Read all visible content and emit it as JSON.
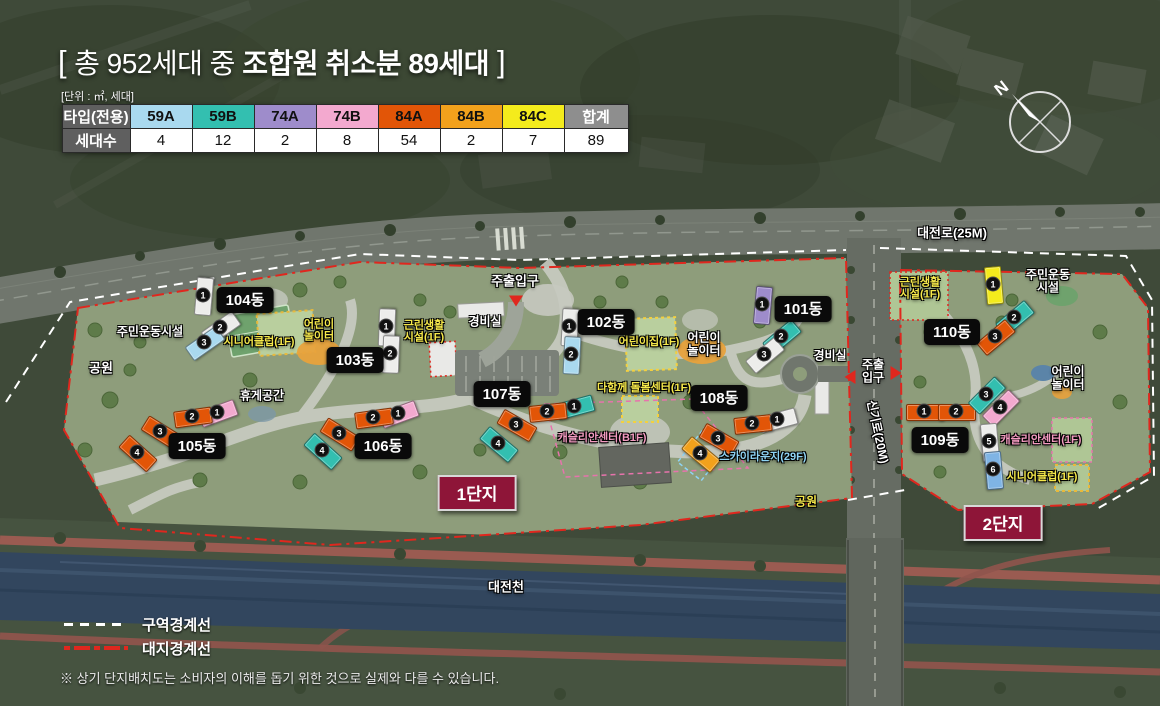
{
  "title": {
    "open_bracket": "[",
    "normal": "총 952세대 중 ",
    "bold": "조합원 취소분 89세대",
    "close_bracket": "]"
  },
  "unit_note": "[단위 : ㎡, 세대]",
  "table": {
    "header_label": "타입(전용)",
    "row_label": "세대수",
    "total_label": "합계",
    "total_count": "89",
    "types": [
      {
        "label": "59A",
        "count": "4",
        "color": "#A9D9EF"
      },
      {
        "label": "59B",
        "count": "12",
        "color": "#33BFB0"
      },
      {
        "label": "74A",
        "count": "2",
        "color": "#9E8CCB"
      },
      {
        "label": "74B",
        "count": "8",
        "color": "#F3A9CF"
      },
      {
        "label": "84A",
        "count": "54",
        "color": "#E25507"
      },
      {
        "label": "84B",
        "count": "2",
        "color": "#F2A11C"
      },
      {
        "label": "84C",
        "count": "7",
        "color": "#F4EB1C"
      }
    ]
  },
  "compass": {
    "north_label": "N"
  },
  "legend": [
    {
      "label": "구역경계선",
      "style": "ls-white"
    },
    {
      "label": "대지경계선",
      "style": "ls-red"
    }
  ],
  "footnote": "※ 상기 단지배치도는 소비자의 이해를 돕기 위한 것으로 실제와 다를 수 있습니다.",
  "colors": {
    "unit_types": {
      "white": "#EDEDEB",
      "lightblue": "#A9D9EF",
      "teal": "#33BFB0",
      "purple": "#9E8CCB",
      "pink": "#F3A9CF",
      "orangered": "#E25507",
      "orange": "#F2A11C",
      "yellow": "#F4EB1C",
      "blue": "#7FB4E4"
    },
    "boundary_zone": "#FFFFFF",
    "boundary_site": "#E0271E",
    "danji_bg": "#8E1538",
    "building_pill_bg": "#0A0A0A"
  },
  "map": {
    "districts": [
      {
        "text": "1단지",
        "x": 477,
        "y": 493
      },
      {
        "text": "2단지",
        "x": 1003,
        "y": 523
      }
    ],
    "buildings": [
      {
        "name": "101동",
        "px": 803,
        "py": 309,
        "units": [
          {
            "n": "1",
            "c": "purple",
            "x": 762,
            "y": 304,
            "r": -85
          },
          {
            "n": "2",
            "c": "teal",
            "x": 781,
            "y": 336,
            "r": -40
          },
          {
            "n": "3",
            "c": "white",
            "x": 764,
            "y": 354,
            "r": -40
          }
        ]
      },
      {
        "name": "102동",
        "px": 606,
        "py": 322,
        "units": [
          {
            "n": "1",
            "c": "white",
            "x": 569,
            "y": 326,
            "r": -87
          },
          {
            "n": "2",
            "c": "lightblue",
            "x": 571,
            "y": 354,
            "r": -87
          }
        ]
      },
      {
        "name": "103동",
        "px": 355,
        "py": 360,
        "units": [
          {
            "n": "1",
            "c": "white",
            "x": 386,
            "y": 326,
            "r": -88
          },
          {
            "n": "2",
            "c": "white",
            "x": 390,
            "y": 353,
            "r": -88
          }
        ]
      },
      {
        "name": "104동",
        "px": 245,
        "py": 300,
        "units": [
          {
            "n": "1",
            "c": "white",
            "x": 203,
            "y": 295,
            "r": -85
          },
          {
            "n": "2",
            "c": "white",
            "x": 220,
            "y": 327,
            "r": -35
          },
          {
            "n": "3",
            "c": "lightblue",
            "x": 204,
            "y": 342,
            "r": -35
          }
        ]
      },
      {
        "name": "105동",
        "px": 197,
        "py": 446,
        "units": [
          {
            "n": "1",
            "c": "pink",
            "x": 217,
            "y": 412,
            "r": -20
          },
          {
            "n": "2",
            "c": "orangered",
            "x": 192,
            "y": 416,
            "r": -8
          },
          {
            "n": "3",
            "c": "orangered",
            "x": 160,
            "y": 431,
            "r": 32
          },
          {
            "n": "4",
            "c": "orangered",
            "x": 137,
            "y": 452,
            "r": 42
          }
        ]
      },
      {
        "name": "106동",
        "px": 383,
        "py": 446,
        "units": [
          {
            "n": "1",
            "c": "pink",
            "x": 398,
            "y": 413,
            "r": -20
          },
          {
            "n": "2",
            "c": "orangered",
            "x": 373,
            "y": 417,
            "r": -8
          },
          {
            "n": "3",
            "c": "orangered",
            "x": 339,
            "y": 433,
            "r": 32
          },
          {
            "n": "4",
            "c": "teal",
            "x": 322,
            "y": 450,
            "r": 42
          }
        ]
      },
      {
        "name": "107동",
        "px": 502,
        "py": 394,
        "units": [
          {
            "n": "1",
            "c": "teal",
            "x": 574,
            "y": 406,
            "r": -15
          },
          {
            "n": "2",
            "c": "orangered",
            "x": 547,
            "y": 411,
            "r": -6
          },
          {
            "n": "3",
            "c": "orangered",
            "x": 516,
            "y": 424,
            "r": 30
          },
          {
            "n": "4",
            "c": "teal",
            "x": 498,
            "y": 443,
            "r": 40
          }
        ]
      },
      {
        "name": "108동",
        "px": 719,
        "py": 398,
        "units": [
          {
            "n": "1",
            "c": "white",
            "x": 777,
            "y": 419,
            "r": -15
          },
          {
            "n": "2",
            "c": "orangered",
            "x": 752,
            "y": 423,
            "r": -6
          },
          {
            "n": "3",
            "c": "orangered",
            "x": 718,
            "y": 438,
            "r": 30
          },
          {
            "n": "4",
            "c": "orange",
            "x": 700,
            "y": 453,
            "r": 40
          }
        ]
      },
      {
        "name": "109동",
        "px": 940,
        "py": 440,
        "units": [
          {
            "n": "1",
            "c": "orangered",
            "x": 924,
            "y": 411,
            "r": 0
          },
          {
            "n": "2",
            "c": "orangered",
            "x": 956,
            "y": 411,
            "r": 0
          },
          {
            "n": "3",
            "c": "teal",
            "x": 986,
            "y": 394,
            "r": -45
          },
          {
            "n": "4",
            "c": "pink",
            "x": 1000,
            "y": 407,
            "r": -45
          },
          {
            "n": "5",
            "c": "white",
            "x": 989,
            "y": 441,
            "r": 85
          },
          {
            "n": "6",
            "c": "blue",
            "x": 993,
            "y": 469,
            "r": 85
          }
        ]
      },
      {
        "name": "110동",
        "px": 952,
        "py": 332,
        "units": [
          {
            "n": "1",
            "c": "yellow",
            "x": 993,
            "y": 284,
            "r": 85
          },
          {
            "n": "2",
            "c": "teal",
            "x": 1014,
            "y": 317,
            "r": -40
          },
          {
            "n": "3",
            "c": "orangered",
            "x": 995,
            "y": 336,
            "r": -40
          }
        ]
      }
    ],
    "labels": [
      {
        "text": "주민운동시설",
        "x": 150,
        "y": 332,
        "cls": "lc-white",
        "size": 12
      },
      {
        "text": "공원",
        "x": 101,
        "y": 369,
        "cls": "lc-white",
        "size": 13
      },
      {
        "text": "시니어클럽(1F)",
        "x": 259,
        "y": 342,
        "cls": "lc-yellow",
        "size": 11
      },
      {
        "text": "어린이\n놀이터",
        "x": 319,
        "y": 331,
        "cls": "lc-yellow",
        "size": 11
      },
      {
        "text": "근린생활\n시설(1F)",
        "x": 424,
        "y": 332,
        "cls": "lc-yellow",
        "size": 11
      },
      {
        "text": "경비실",
        "x": 485,
        "y": 322,
        "cls": "lc-white",
        "size": 12
      },
      {
        "text": "주출입구",
        "x": 515,
        "y": 282,
        "cls": "lc-white",
        "size": 13
      },
      {
        "text": "어린이집(1F)",
        "x": 649,
        "y": 342,
        "cls": "lc-yellow",
        "size": 11
      },
      {
        "text": "어린이\n놀이터",
        "x": 704,
        "y": 345,
        "cls": "lc-white",
        "size": 12
      },
      {
        "text": "다함께 돌봄센터(1F)",
        "x": 644,
        "y": 388,
        "cls": "lc-yellow",
        "size": 11
      },
      {
        "text": "캐슬리안센터(B1F)",
        "x": 602,
        "y": 438,
        "cls": "lc-pink",
        "size": 11
      },
      {
        "text": "스카이라운지(29F)",
        "x": 763,
        "y": 457,
        "cls": "lc-skyblue",
        "size": 11
      },
      {
        "text": "경비실",
        "x": 830,
        "y": 356,
        "cls": "lc-white",
        "size": 12
      },
      {
        "text": "대전로(25M)",
        "x": 952,
        "y": 234,
        "cls": "lc-white",
        "size": 13
      },
      {
        "text": "근린생활\n시설(1F)",
        "x": 920,
        "y": 289,
        "cls": "lc-yellow",
        "size": 11
      },
      {
        "text": "주민운동\n시설",
        "x": 1048,
        "y": 282,
        "cls": "lc-white",
        "size": 12
      },
      {
        "text": "주출\n입구",
        "x": 873,
        "y": 372,
        "cls": "lc-white",
        "size": 12
      },
      {
        "text": "신기로(20M)",
        "x": 877,
        "y": 432,
        "cls": "lc-white",
        "size": 12,
        "rot": 78
      },
      {
        "text": "어린이\n놀이터",
        "x": 1068,
        "y": 379,
        "cls": "lc-white",
        "size": 12
      },
      {
        "text": "캐슬리안센터(1F)",
        "x": 1041,
        "y": 440,
        "cls": "lc-pink",
        "size": 11
      },
      {
        "text": "시니어클럽(1F)",
        "x": 1042,
        "y": 477,
        "cls": "lc-yellow",
        "size": 11
      },
      {
        "text": "공원",
        "x": 806,
        "y": 502,
        "cls": "lc-yellow",
        "size": 12
      },
      {
        "text": "휴게공간",
        "x": 262,
        "y": 396,
        "cls": "lc-white",
        "size": 12
      },
      {
        "text": "대전천",
        "x": 506,
        "y": 588,
        "cls": "lc-white",
        "size": 13
      }
    ],
    "markers": [
      {
        "dir": "down",
        "x": 516,
        "y": 301
      },
      {
        "dir": "left",
        "x": 850,
        "y": 377
      },
      {
        "dir": "right",
        "x": 896,
        "y": 373
      }
    ]
  }
}
